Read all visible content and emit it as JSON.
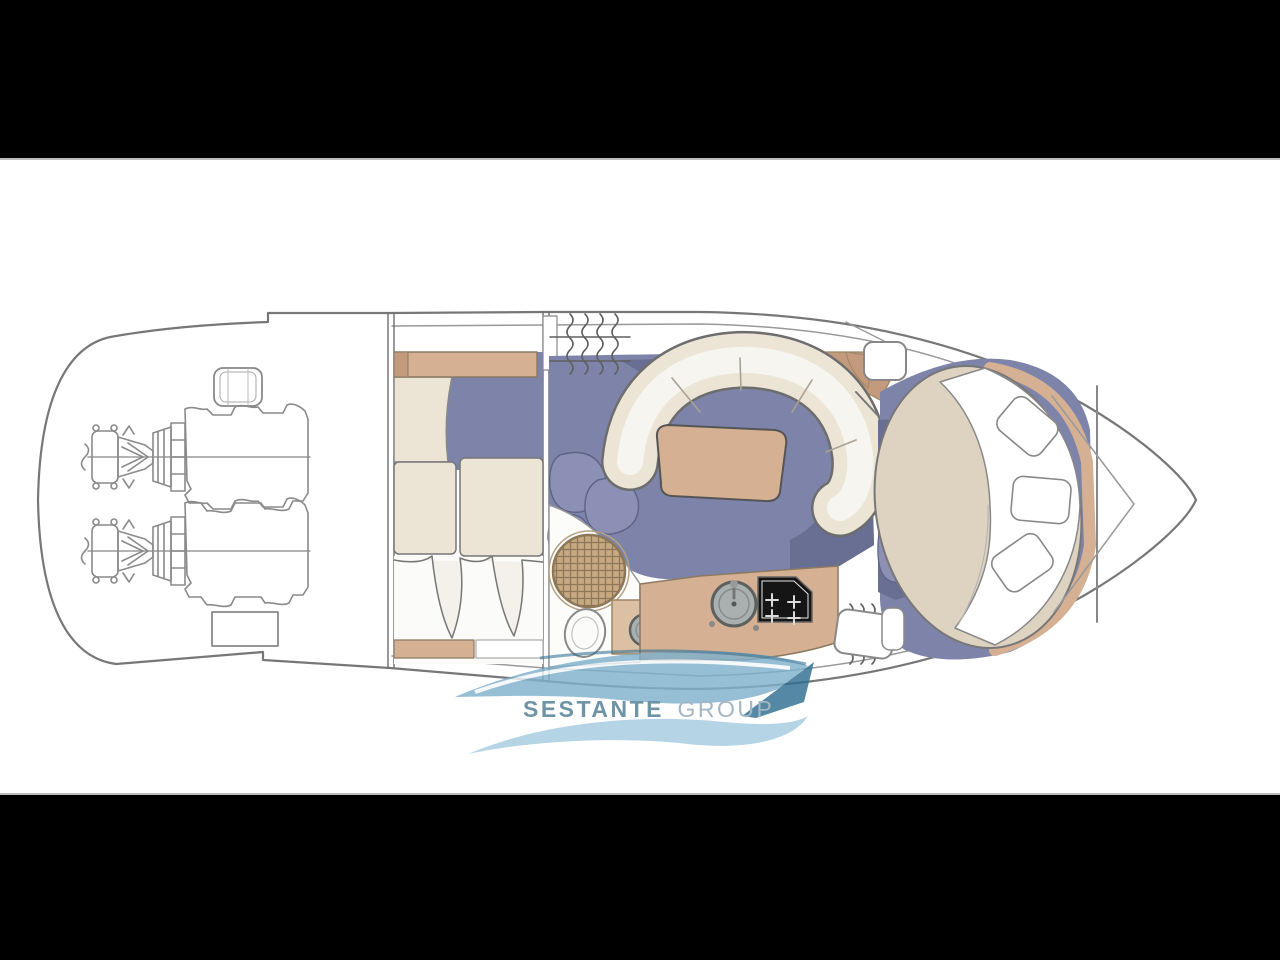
{
  "watermark": {
    "brand": "SESTANTE",
    "brand_suffix": "GROUP"
  },
  "palette": {
    "letterbox": "#000000",
    "canvas": "#ffffff",
    "canvas_border": "#bdbdbd",
    "line": "#777777",
    "line_light": "#999999",
    "carpet": "#7e84a9",
    "carpet_dark": "#696e93",
    "carpet_petal": "#8b90b4",
    "upholstery": "#ece5d6",
    "upholstery_inner": "#f7f5ef",
    "wood": "#d5b093",
    "wood_dark": "#c39a7c",
    "wood_edge": "#8a7a62",
    "bed": "#ded3c0",
    "grate": "#c6a981",
    "grate_grid": "#8d7758",
    "steel": "#a9b0af",
    "steel_edge": "#5c6160",
    "stove": "#151515",
    "logo_teal": "#4f7d92",
    "logo_gray": "#8fa7b8",
    "logo_blue_light": "#a5cde2",
    "logo_blue_mid": "#7fb0cb",
    "logo_blue_dark": "#2f6f92"
  }
}
